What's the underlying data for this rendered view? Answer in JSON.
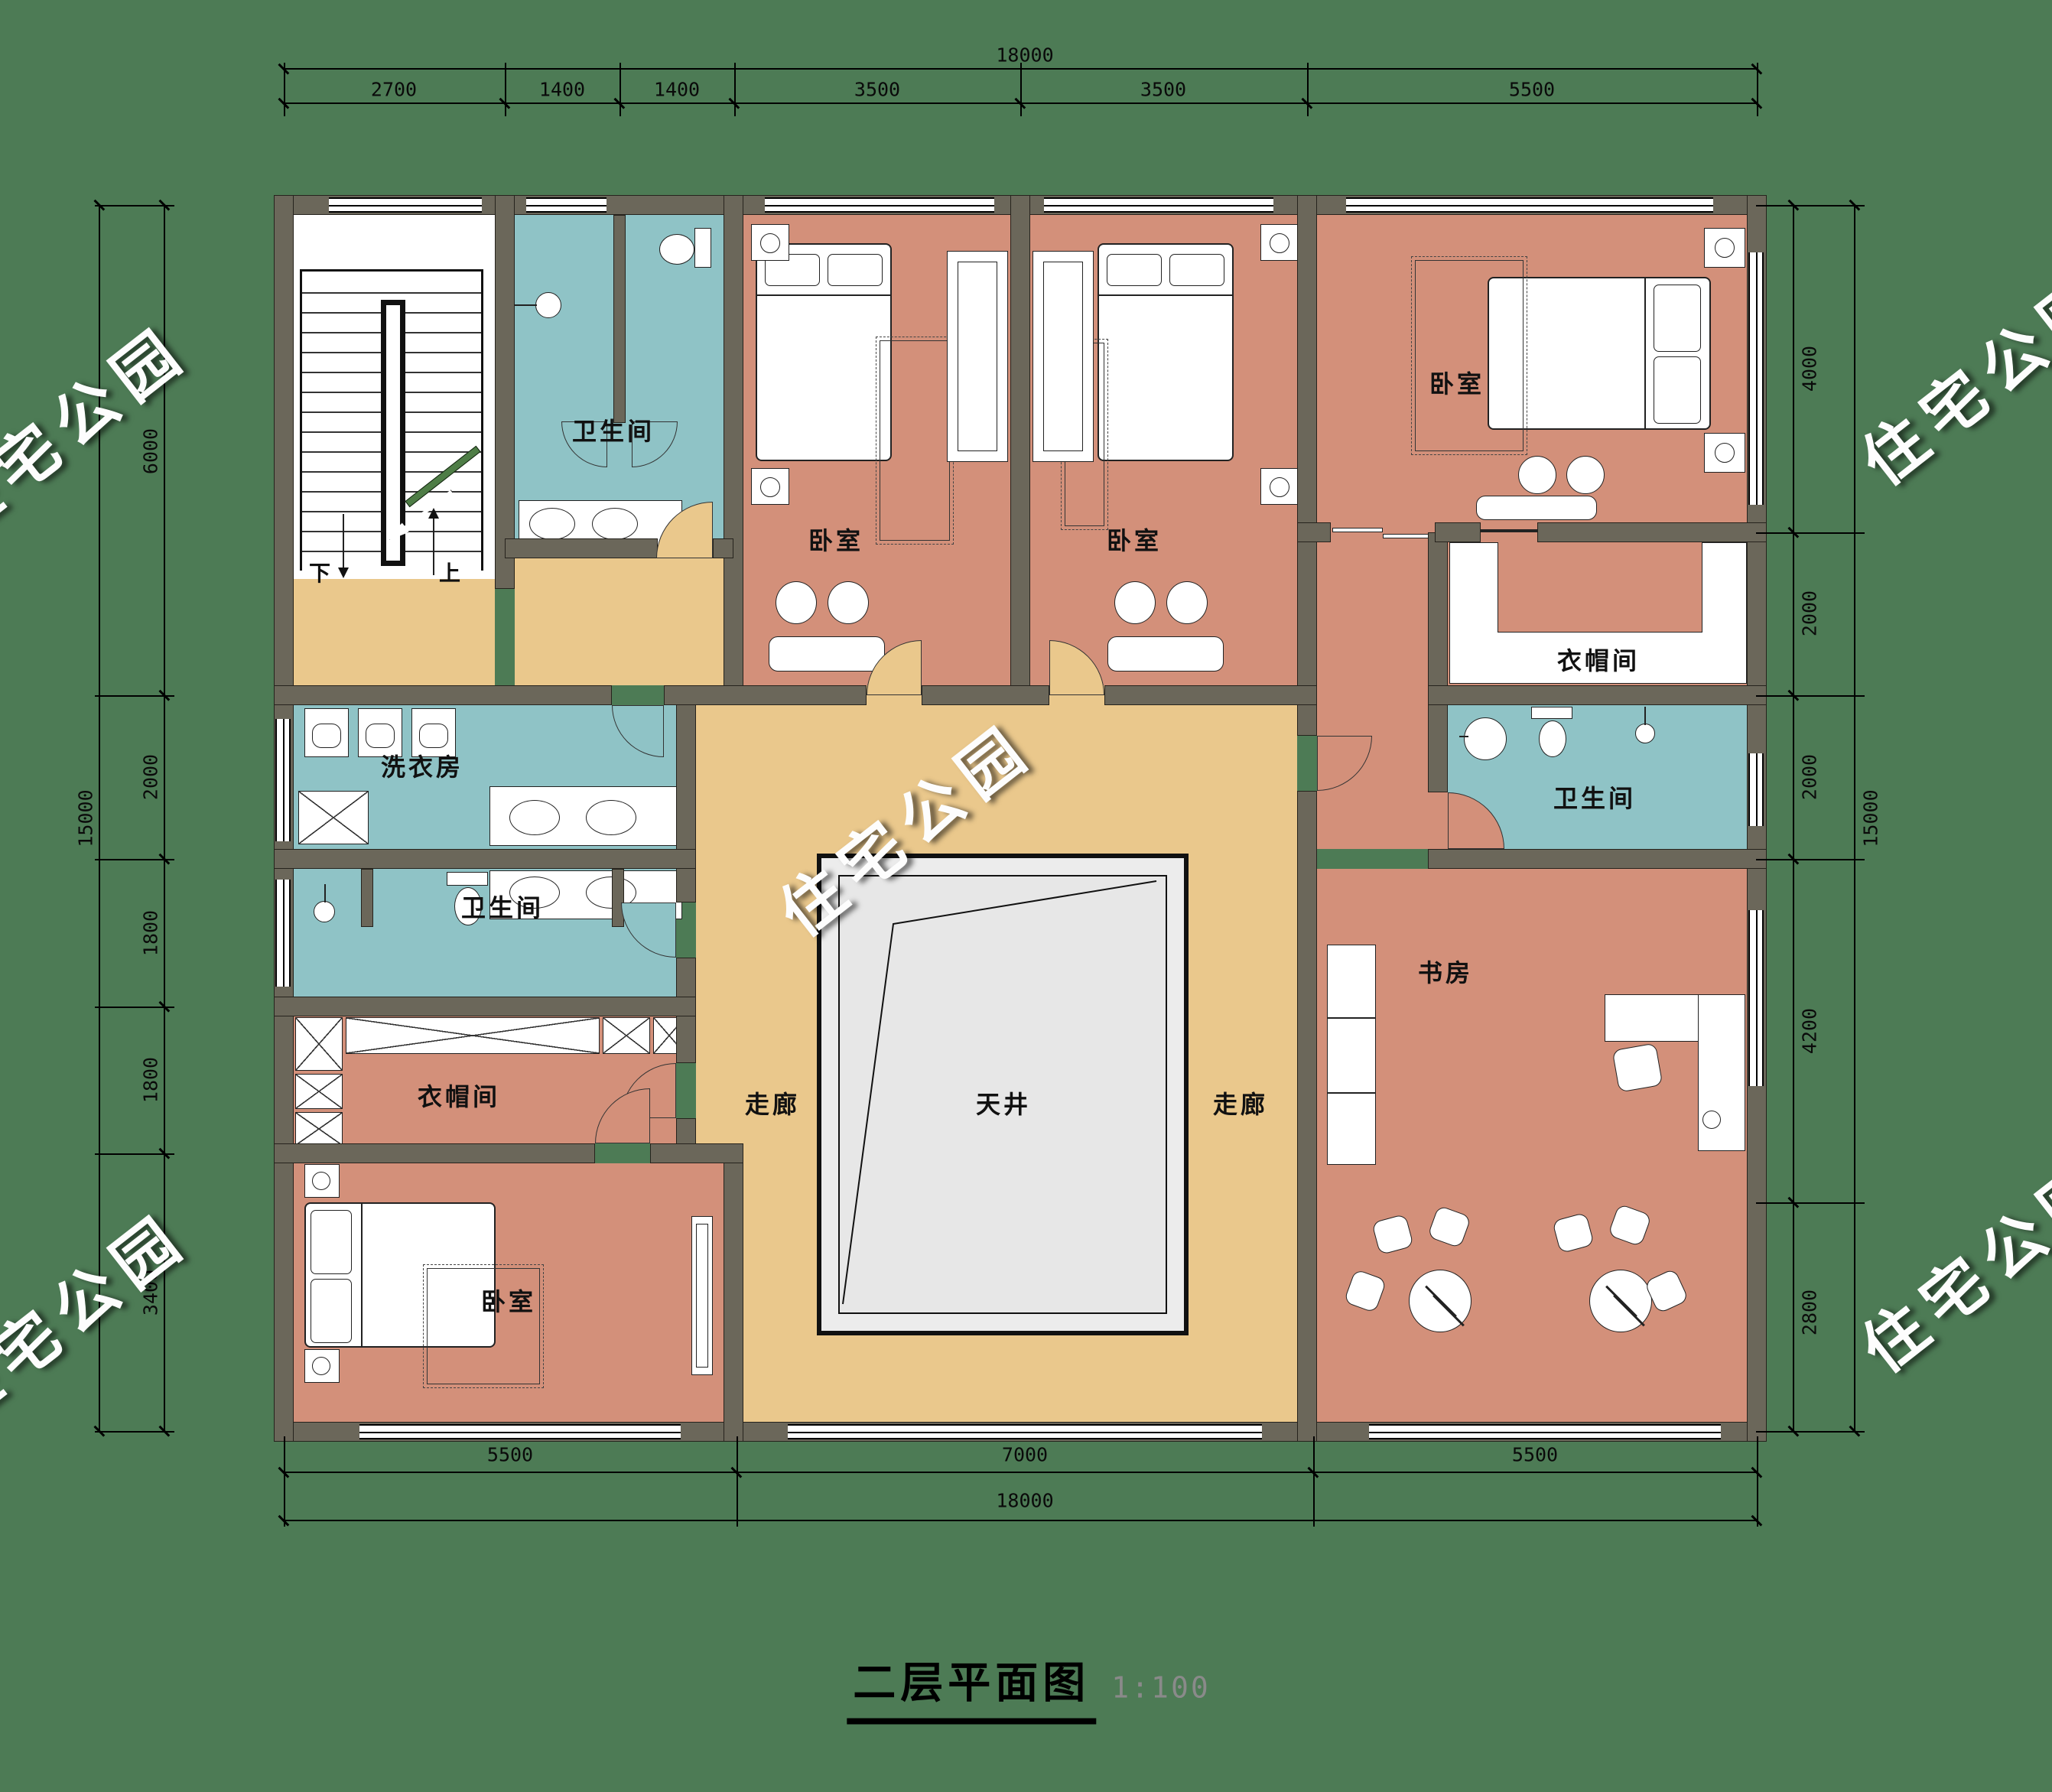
{
  "title": {
    "text": "二层平面图",
    "scale": "1:100"
  },
  "watermark": {
    "text": "住宅公园"
  },
  "labels": {
    "bedroom": "卧室",
    "bathroom": "卫生间",
    "cloakroom": "衣帽间",
    "laundry": "洗衣房",
    "study": "书房",
    "corridor": "走廊",
    "lightwell": "天井",
    "stair_down": "下",
    "stair_up": "上"
  },
  "dims": {
    "top_total": "18000",
    "top": [
      "2700",
      "1400",
      "1400",
      "3500",
      "3500",
      "5500"
    ],
    "bottom": [
      "5500",
      "7000",
      "5500"
    ],
    "bottom_total": "18000",
    "left_total": "15000",
    "left": [
      "6000",
      "2000",
      "1800",
      "1800",
      "3400"
    ],
    "right": [
      "4000",
      "2000",
      "2000",
      "4200",
      "2800"
    ],
    "right_total": "15000"
  },
  "colors": {
    "background": "#4d7b55",
    "wall": "#6b675a",
    "bedroom_floor": "#d3907a",
    "corridor_floor": "#eac88c",
    "bath_floor": "#8fc3c6",
    "lightwell": "#ececec",
    "watermark": "#ffffff"
  }
}
